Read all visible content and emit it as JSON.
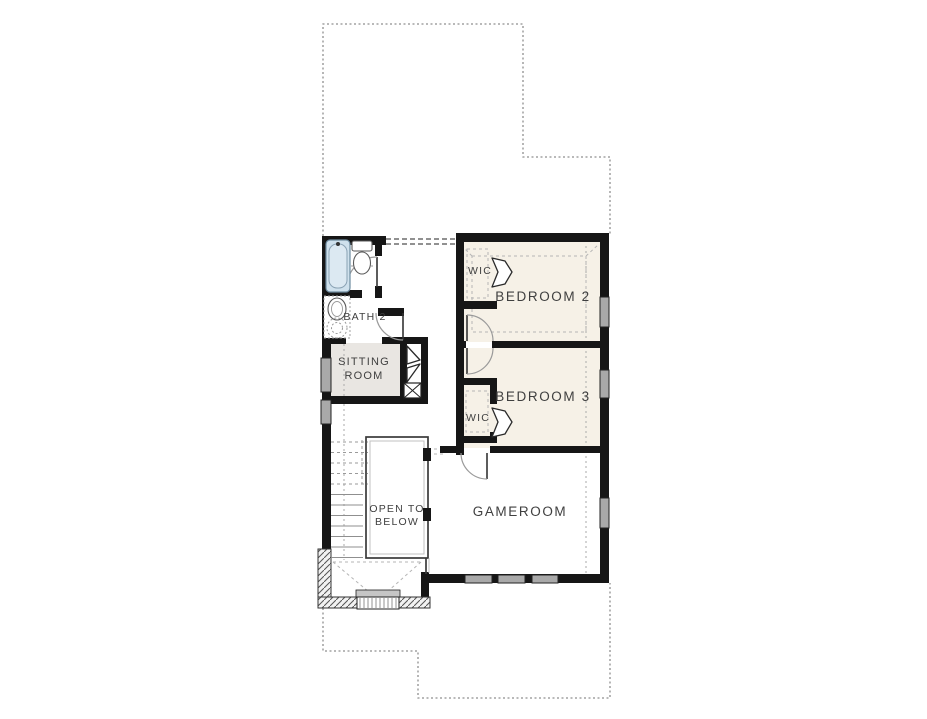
{
  "plan": {
    "name": "Second Floor Plan",
    "labels": {
      "bath2": "BATH 2",
      "sitting_line1": "SITTING",
      "sitting_line2": "ROOM",
      "wic_bedroom2": "WIC",
      "bedroom2": "BEDROOM 2",
      "wic_bedroom3": "WIC",
      "bedroom3": "BEDROOM 3",
      "gameroom": "GAMEROOM",
      "open_below_line1": "OPEN TO",
      "open_below_line2": "BELOW"
    },
    "colors": {
      "bg": "#ffffff",
      "wall": "#161616",
      "room-fill": "#f6f1e7",
      "sitting-fill": "#e9e6e2",
      "window": "#a9a9a9",
      "window-frame": "#222222",
      "tub-fill": "#cfe1ed",
      "tub-stroke": "#6f8ca0",
      "fixture-stroke": "#5a5a5a",
      "door-arc": "#9a9a9a",
      "door-leaf": "#333333",
      "dash": "#8f8f8f",
      "dash-light": "#b5b5b5",
      "label": "#3f3f3f",
      "rail": "#3a3a3a",
      "rail-inner": "#c0c0c0"
    }
  }
}
